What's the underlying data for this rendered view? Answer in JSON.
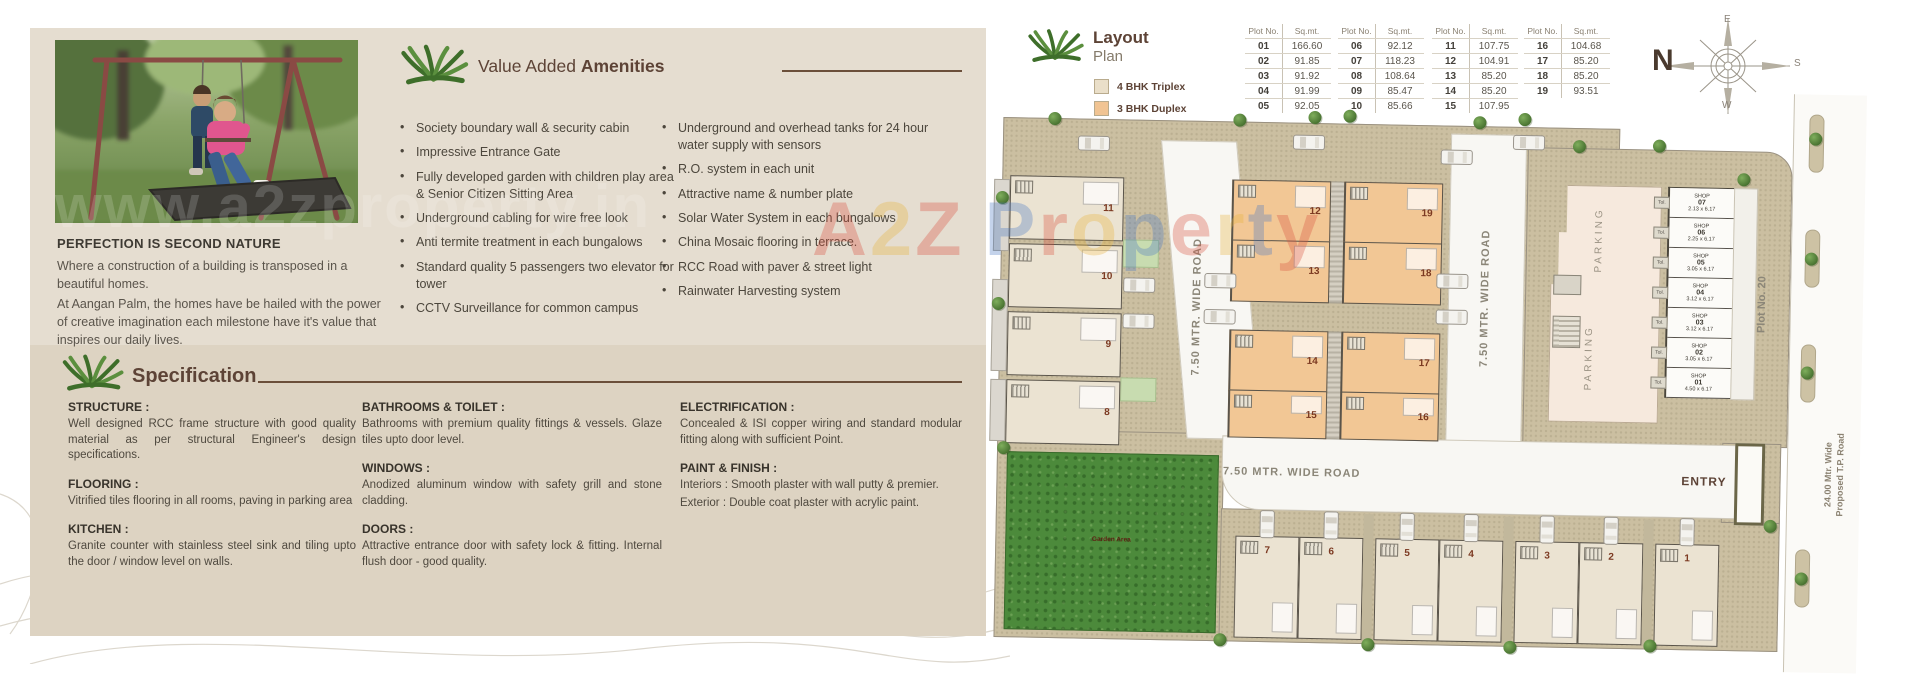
{
  "watermark": {
    "url_text": "www.a2zproperty.in",
    "letters": [
      {
        "ch": "A",
        "color": "#d94f3d"
      },
      {
        "ch": "2",
        "color": "#e8b33a"
      },
      {
        "ch": "Z",
        "color": "#d94f3d"
      },
      {
        "ch": "P",
        "color": "#4a79c4"
      },
      {
        "ch": "r",
        "color": "#d94f3d"
      },
      {
        "ch": "o",
        "color": "#e8b33a"
      },
      {
        "ch": "p",
        "color": "#4a79c4"
      },
      {
        "ch": "e",
        "color": "#d94f3d"
      },
      {
        "ch": "r",
        "color": "#e8b33a"
      },
      {
        "ch": "t",
        "color": "#4a79c4"
      },
      {
        "ch": "y",
        "color": "#d94f3d"
      }
    ]
  },
  "left_page": {
    "photo_heading": "PERFECTION IS SECOND NATURE",
    "para1": "Where a construction of a building is transposed in a beautiful homes.",
    "para2": "At Aangan Palm, the homes have be hailed with the power of creative imagination each milestone have it's value that inspires our daily lives.",
    "amenities": {
      "title_prefix": "Value Added ",
      "title_bold": "Amenities",
      "left": [
        "Society boundary wall & security cabin",
        "Impressive Entrance Gate",
        "Fully developed garden with children play area & Senior Citizen Sitting Area",
        "Underground cabling for wire free look",
        "Anti termite treatment in each bungalows",
        "Standard quality 5 passengers two elevator for tower",
        "CCTV Surveillance for common campus"
      ],
      "right": [
        "Underground and overhead tanks for 24 hour water supply with sensors",
        "R.O. system in each unit",
        "Attractive name & number plate",
        "Solar Water System in each bungalows",
        "China Mosaic flooring in terrace.",
        "RCC Road with paver & street light",
        "Rainwater Harvesting system"
      ]
    },
    "specification": {
      "title": "Specification",
      "col1": [
        {
          "h": "STRUCTURE :",
          "b": "Well designed RCC frame structure with good quality material as per structural Engineer's design specifications."
        },
        {
          "h": "FLOORING :",
          "b": "Vitrified tiles flooring in all rooms, paving in parking area"
        },
        {
          "h": "KITCHEN :",
          "b": "Granite counter with stainless steel sink and tiling upto the door / window level on walls."
        }
      ],
      "col2": [
        {
          "h": "BATHROOMS & TOILET :",
          "b": "Bathrooms with premium quality fittings & vessels. Glaze tiles upto door level."
        },
        {
          "h": "WINDOWS :",
          "b": "Anodized aluminum window with safety grill and stone cladding."
        },
        {
          "h": "DOORS :",
          "b": "Attractive entrance door with safety lock & fitting. Internal flush door - good quality."
        }
      ],
      "col3": [
        {
          "h": "ELECTRIFICATION :",
          "b": "Concealed & ISI copper wiring and standard modular fitting along with sufficient Point."
        },
        {
          "h": "PAINT & FINISH :",
          "b": "Interiors : Smooth plaster with wall putty & premier.",
          "b2": "Exterior : Double coat plaster with acrylic paint."
        }
      ]
    }
  },
  "right_page": {
    "title_line1": "Layout",
    "title_line2": "Plan",
    "legend": [
      {
        "label": "4 BHK Triplex",
        "color": "#eadfc9"
      },
      {
        "label": "3 BHK Duplex",
        "color": "#f1c493"
      }
    ],
    "plot_table": {
      "headers": [
        "Plot No.",
        "Sq.mt."
      ],
      "groups": [
        {
          "rows": [
            [
              "01",
              "166.60"
            ],
            [
              "02",
              "91.85"
            ],
            [
              "03",
              "91.92"
            ],
            [
              "04",
              "91.99"
            ],
            [
              "05",
              "92.05"
            ]
          ]
        },
        {
          "rows": [
            [
              "06",
              "92.12"
            ],
            [
              "07",
              "118.23"
            ],
            [
              "08",
              "108.64"
            ],
            [
              "09",
              "85.47"
            ],
            [
              "10",
              "85.66"
            ]
          ]
        },
        {
          "rows": [
            [
              "11",
              "107.75"
            ],
            [
              "12",
              "104.91"
            ],
            [
              "13",
              "85.20"
            ],
            [
              "14",
              "85.20"
            ],
            [
              "15",
              "107.95"
            ]
          ]
        },
        {
          "rows": [
            [
              "16",
              "104.68"
            ],
            [
              "17",
              "85.20"
            ],
            [
              "18",
              "85.20"
            ],
            [
              "19",
              "93.51"
            ]
          ]
        }
      ]
    }
  },
  "site": {
    "road_750": "7.50 MTR. WIDE ROAD",
    "tp_road_line1": "24.00 Mtr. Wide",
    "tp_road_line2": "Proposed T.P. Road",
    "entry_label": "ENTRY",
    "garden_label": "Garden Area",
    "parking_label": "PARKING",
    "plot20_label": "Plot No. 20",
    "shop_word": "SHOP",
    "tol_label": "Tol.",
    "plots_left_column": [
      "11",
      "10",
      "9",
      "8"
    ],
    "plots_mid_column": [
      "12",
      "13",
      "14",
      "15"
    ],
    "plots_right_column": [
      "19",
      "18",
      "17",
      "16"
    ],
    "plots_bottom_row": [
      "7",
      "6",
      "5",
      "4",
      "3",
      "2",
      "1"
    ],
    "shops": [
      {
        "no": "07",
        "dim": "2.13 x 6.17"
      },
      {
        "no": "06",
        "dim": "2.25 x 6.17"
      },
      {
        "no": "05",
        "dim": "3.05 x 6.17"
      },
      {
        "no": "04",
        "dim": "3.12 x 6.17"
      },
      {
        "no": "03",
        "dim": "3.12 x 6.17"
      },
      {
        "no": "02",
        "dim": "3.05 x 6.17"
      },
      {
        "no": "01",
        "dim": "4.50 x 6.17"
      }
    ],
    "compass": {
      "n": "N",
      "e": "E",
      "s": "S",
      "w": "W"
    }
  },
  "colors": {
    "panel_beige": "#e5ddd0",
    "spec_band": "#ddd3c2",
    "accent_brown": "#5d4336",
    "palm_green": "#4e7c31",
    "triplex": "#ebe3d2",
    "duplex": "#f2c795",
    "site_tan": "#cbbfa1",
    "garden_green": "#4c8a3b"
  }
}
